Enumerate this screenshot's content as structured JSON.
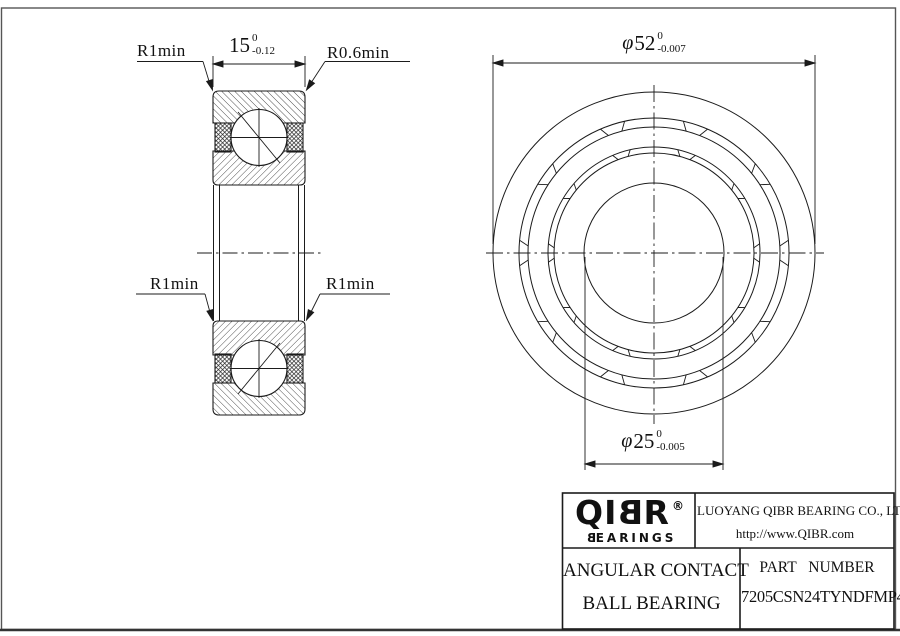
{
  "drawing": {
    "section_view": {
      "dim_width": {
        "value": "15",
        "tol_upper": "0",
        "tol_lower": "-0.12"
      },
      "label_radius_top_left": "R1min",
      "label_radius_top_right": "R0.6min",
      "label_radius_bottom_left": "R1min",
      "label_radius_bottom_right": "R1min"
    },
    "front_view": {
      "dim_outer_diameter": {
        "prefix": "φ",
        "value": "52",
        "tol_upper": "0",
        "tol_lower": "-0.007"
      },
      "dim_bore_diameter": {
        "prefix": "φ",
        "value": "25",
        "tol_upper": "0",
        "tol_lower": "-0.005"
      }
    }
  },
  "title_block": {
    "logo": {
      "text_qi": "QI",
      "text_b": "B",
      "text_r": "R",
      "registered": "®",
      "tagline_b": "B",
      "tagline_rest": "EARINGS"
    },
    "company": "LUOYANG QIBR BEARING CO., LTD",
    "website": "http://www.QIBR.com",
    "product_line1": "ANGULAR CONTACT",
    "product_line2": "BALL BEARING",
    "part_label": "PART NUMBER",
    "part_number": "7205CSN24TYNDFMP4"
  },
  "colors": {
    "line": "#1b1b1b",
    "background": "#ffffff"
  }
}
